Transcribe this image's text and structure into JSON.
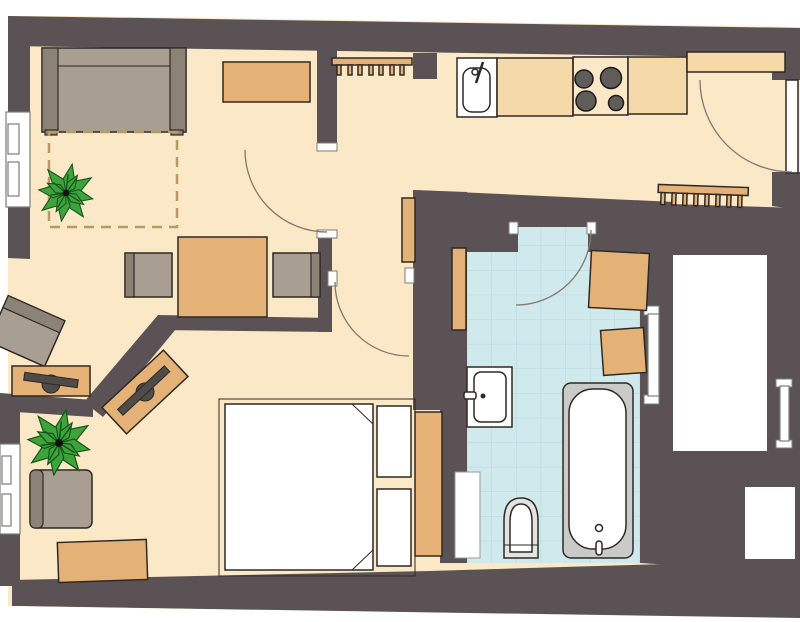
{
  "title": "One-bedroom apartment floor plan",
  "palette": {
    "white": "#ffffff",
    "wall": "#5a5254",
    "floor": "#fbe8c6",
    "furniture": "#e4b276",
    "counter": "#f6d9a9",
    "stove": "#7c7875",
    "burner": "#605c59",
    "sofa": "#a89e91",
    "sofa_dark": "#8c8275",
    "tv": "#4f4b48",
    "rug_dash": "#b99a64",
    "tile": "#cfe9ed",
    "tile_line": "#b5d8de",
    "bed_base": "#edf4f6",
    "fixture_gray": "#e3e3e1",
    "tub_rim": "#cacac8",
    "plant": "#3fa33c",
    "plant_dark": "#14551a",
    "outline": "#2e2925",
    "door_arc": "#82786e",
    "window_frame": "#7d7d7b"
  },
  "rooms": {
    "living_room": {
      "name": "living room",
      "furniture": [
        "sofa",
        "rug",
        "houseplant",
        "sideboard",
        "radiator",
        "dining-table",
        "dining-chair",
        "dining-chair",
        "armchair",
        "tv-lowboard"
      ]
    },
    "hallway_kitchen": {
      "name": "hall / kitchen",
      "furniture": [
        "sink-counter",
        "countertop",
        "stove",
        "countertop",
        "wall-shelf",
        "radiator",
        "slim-cabinet",
        "entrance-door"
      ]
    },
    "bathroom": {
      "name": "bathroom",
      "furniture": [
        "tiled-floor",
        "washbasin",
        "bathtub",
        "toilet",
        "cabinet",
        "cabinet",
        "tall-cabinet",
        "duct-niche"
      ]
    },
    "bedroom": {
      "name": "bedroom",
      "furniture": [
        "double-bed",
        "wardrobe",
        "tv-lowboard",
        "armchair",
        "houseplant",
        "sideboard"
      ]
    }
  },
  "openings": {
    "windows": 4,
    "interior_doors": 3,
    "entrance_doors": 1
  }
}
